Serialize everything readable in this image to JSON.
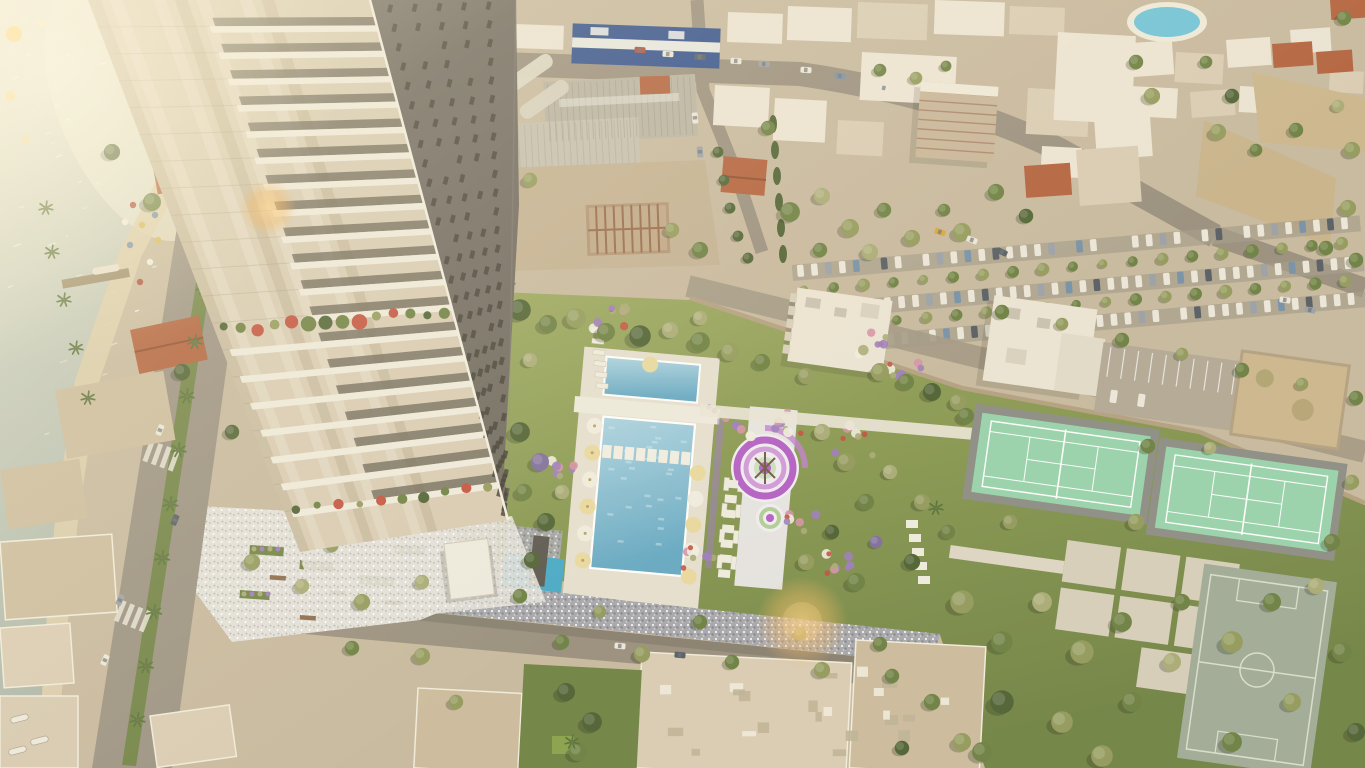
{
  "scene": {
    "title": "Aerial rendering of a seafront residential tower development",
    "camera": "top-down aerial view, diagonal composition",
    "lighting": "warm afternoon sunlight from the upper left with orange lens flares",
    "description": "Top-down architectural rendering of a high-rise seafront tower with a landscaped amenity deck (swimming pools, spiral playground, flower gardens, tennis courts, football pitch, park), a white pebble plaza, a palm-lined coastal road, beach and sea at the upper left, and the surrounding Mediterranean city with warehouses, a blue supermarket, parking rows, resort pool and sandy lots.",
    "features": [
      "sea",
      "beach with umbrellas",
      "marina pier",
      "shoreline villas with red roofs",
      "coastal road with palm median",
      "residential tower",
      "tower balcony gardens",
      "entrance canopy",
      "water feature",
      "kids pool",
      "white pebble plaza",
      "amenity deck gardens",
      "upper pool",
      "main swimming pool",
      "stepping stones",
      "pool umbrellas",
      "sun loungers",
      "spiral playground",
      "perimeter wall",
      "neighbour apartment buildings",
      "striped parking lot",
      "tree-lined parking rows",
      "tennis court 1",
      "tennis court 2",
      "paved slab grid",
      "football pitch",
      "public park",
      "shop row",
      "blue supermarket",
      "warehouse sheds",
      "construction site truss",
      "scaffolded building",
      "resort pool",
      "sandy lots",
      "city streets with cars",
      "rooftop clutter",
      "lens flares"
    ]
  },
  "counts": {
    "tennis_courts": 2,
    "deck_pools": 3,
    "football_pitches": 1,
    "playground_spirals": 2,
    "towers": 1,
    "resort_pools": 1
  },
  "palette": {
    "base_sand": "#c7b99f",
    "sea_bright": "#edecdf",
    "sea_mid": "#c3cabc",
    "sea_deep": "#a4afa3",
    "shore_sand": "#dbcfae",
    "road": "#998f7f",
    "road_light": "#b2a896",
    "road_dark": "#837a6c",
    "pebble": "#a6a7ae",
    "plaza": "#e3e1dc",
    "lawn_light": "#9aa75f",
    "lawn": "#84954f",
    "lawn_dark": "#6f8245",
    "pitch": "#9fab97",
    "court": "#97d3ad",
    "court_edge": "#8c8d86",
    "line_white": "#ffffff",
    "pool_light": "#abd3e2",
    "pool_deep": "#64a8c4",
    "pool_deck": "#e6e0d1",
    "kids_pool": "#45a8c8",
    "tower_light": "#d8ccb4",
    "tower_panel": "#b9ac90",
    "tower_stripe": "#e7e0cf",
    "tower_band": "#efeadd",
    "tower_glass": "#6b6557",
    "tower_dark": "#6e6860",
    "tower_win": "#3f3b33",
    "tower_edge": "#f2eee2",
    "building_white": "#ece5d5",
    "building_cream": "#d9cdb5",
    "building_tan": "#cbbc9e",
    "red_roof": "#b2603c",
    "warehouse": "#b8b3a4",
    "blue_store": "#30508e",
    "wall": "#b2a081",
    "scaffold": "#c9b59b",
    "rust": "#96684a",
    "dirt": "#c2b093",
    "sand_lot": "#ccb68e",
    "tree_dark": "#4d6133",
    "tree_mid": "#6b7f41",
    "tree_olive": "#929a5c",
    "tree_sage": "#a8ab76",
    "tree_light": "#8ba05e",
    "tree_purple": "#7d6d9d",
    "palm": "#567338",
    "flower_purple": "#9d7cbe",
    "flower_pink": "#d592a6",
    "flower_red": "#c2503e",
    "flower_yellow": "#d8b858",
    "spiral_purple": "#b35fc5",
    "spiral_lav": "#d09ad9",
    "spiral_white": "#f1edf3",
    "car_white": "#ece7db",
    "car_gray": "#9aa0a8",
    "car_dark": "#565c64",
    "car_blue": "#7590a8",
    "car_red": "#b04a3a",
    "car_yellow": "#d8a53e",
    "flare": "#f6bb66",
    "glow": "#fff7e2",
    "umbrella_yellow": "#e9d9a0",
    "umbrella_white": "#f1ede1"
  }
}
